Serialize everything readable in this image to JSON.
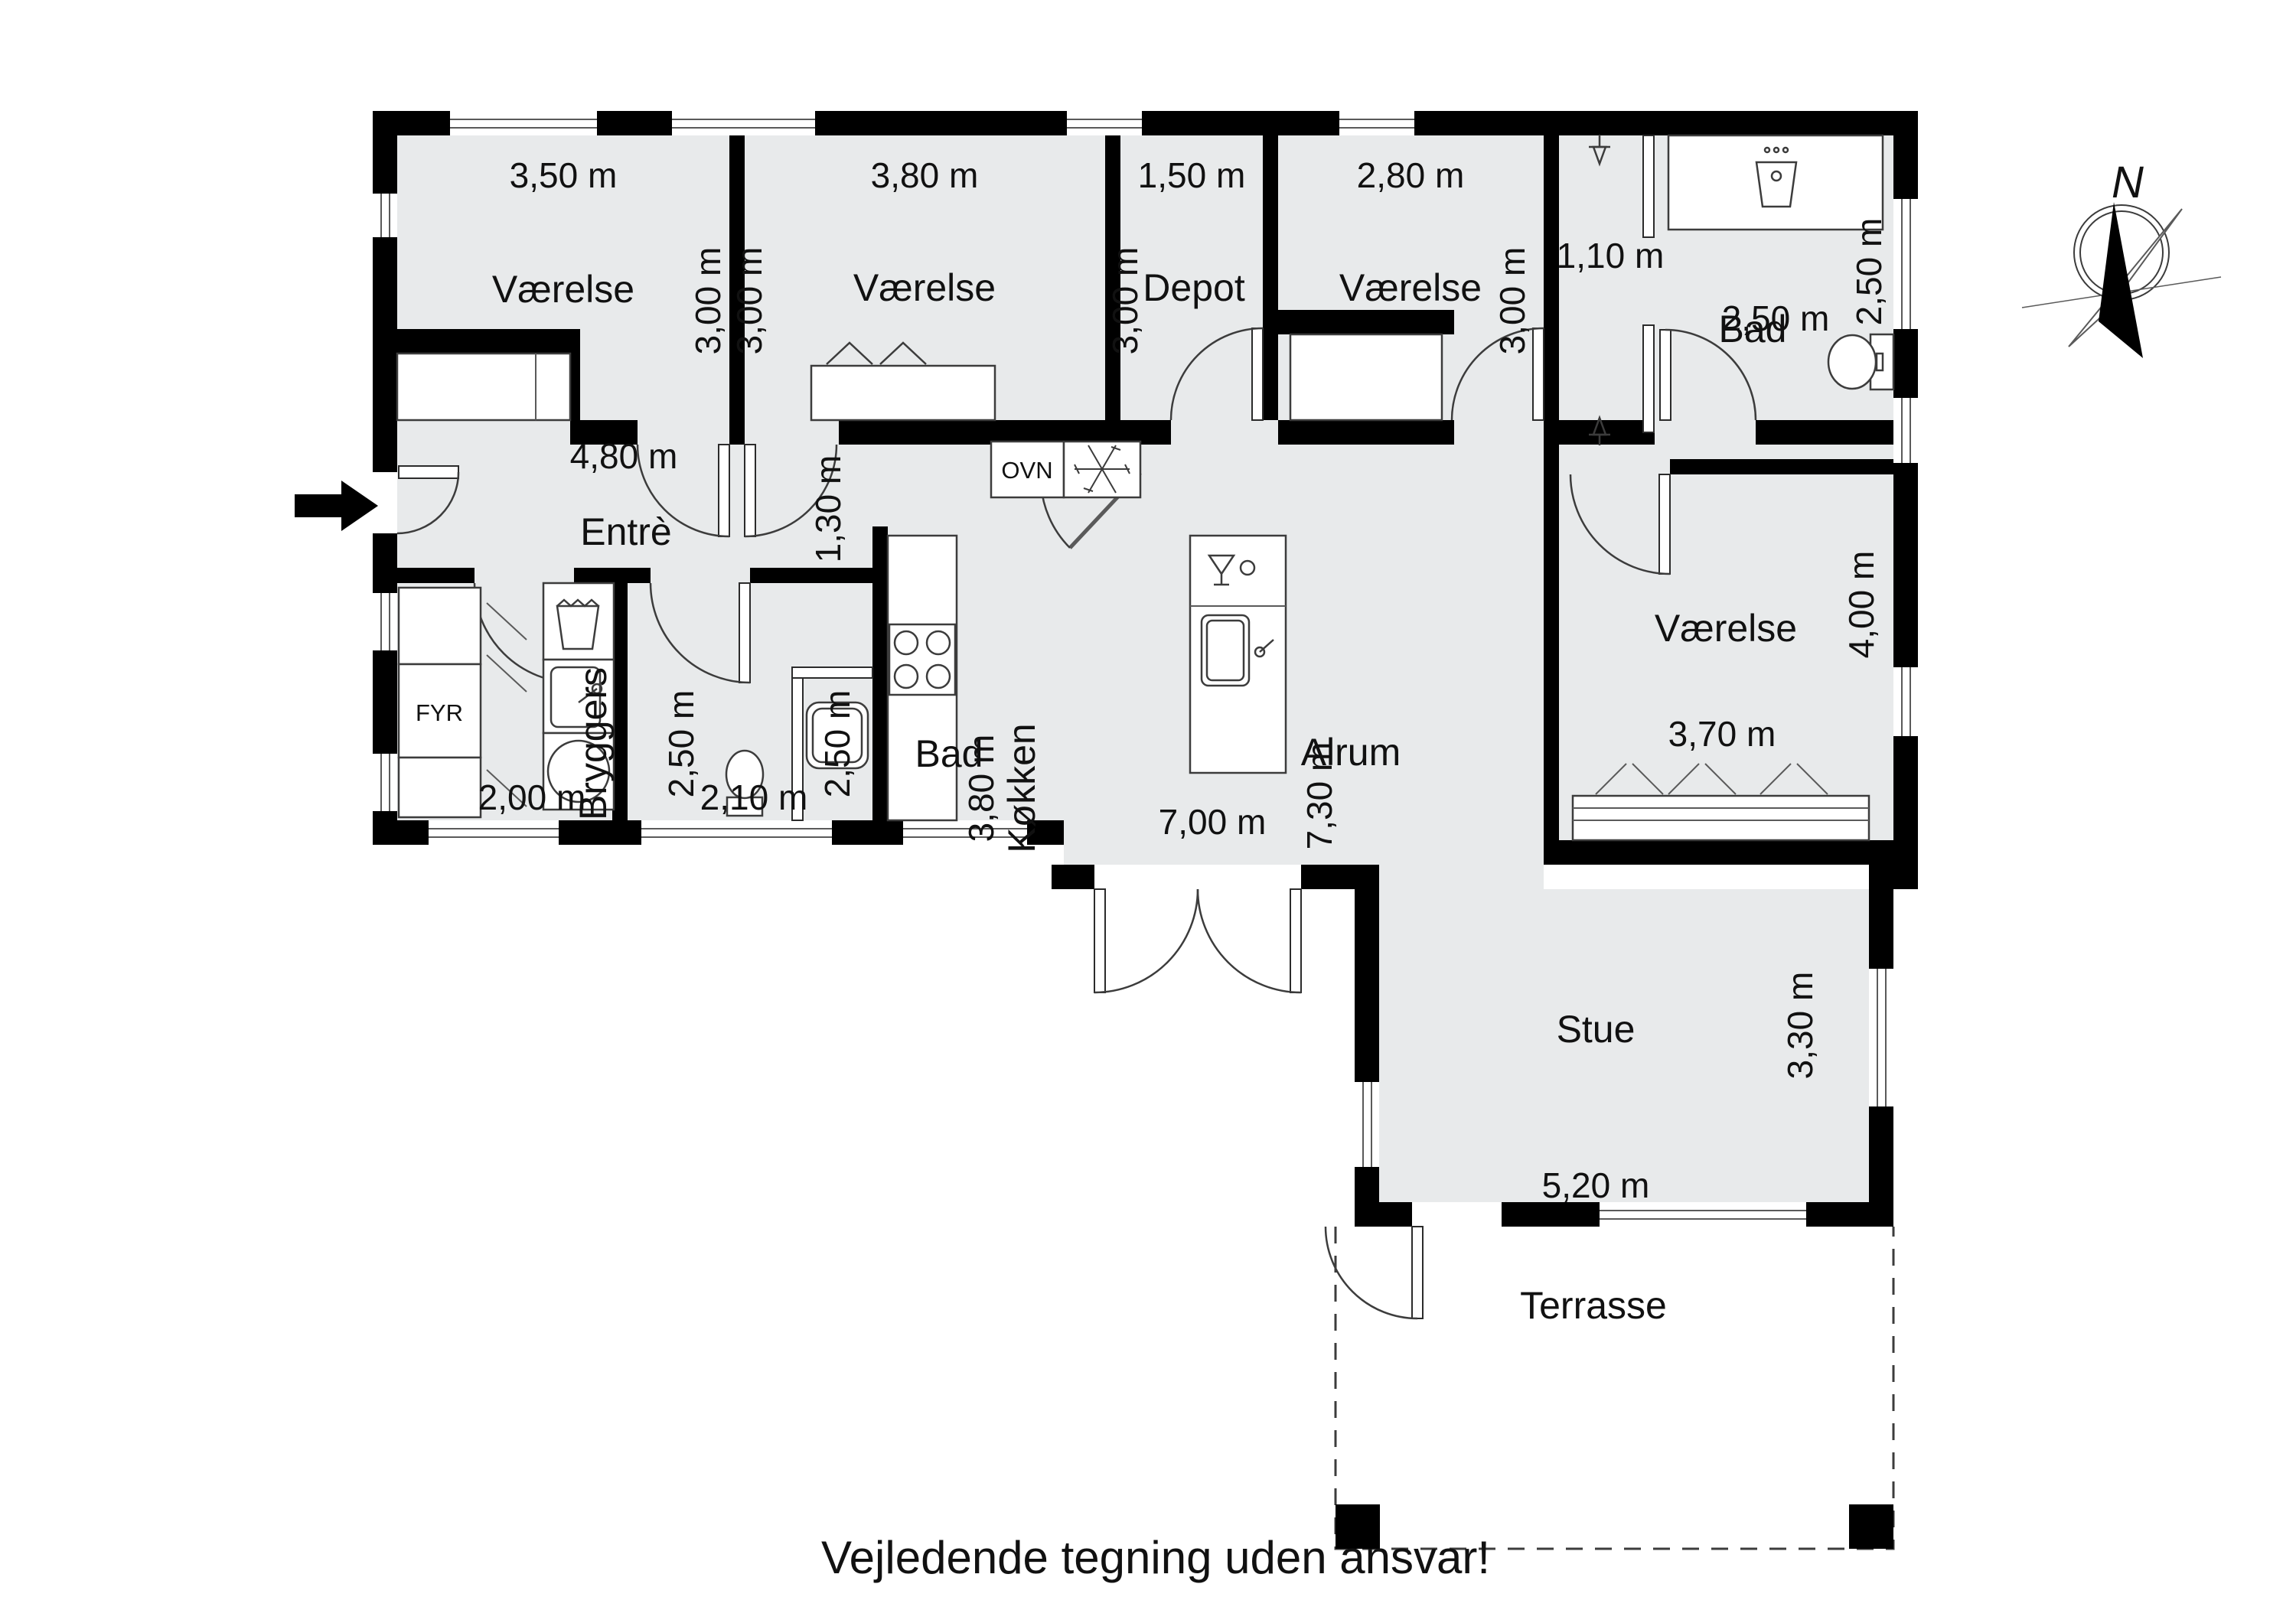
{
  "footer": {
    "disclaimer": "Vejledende tegning uden ansvar!"
  },
  "compass": {
    "north_label": "N"
  },
  "rooms": {
    "vaerelse1": "Værelse",
    "vaerelse2": "Værelse",
    "depot": "Depot",
    "vaerelse3": "Værelse",
    "bad_top": "Bad",
    "entre": "Entrè",
    "bryggers": "Bryggers",
    "bad_mid": "Bad",
    "koekken": "Køkken",
    "alrum": "Alrum",
    "vaerelse4": "Værelse",
    "stue": "Stue",
    "terrasse": "Terrasse"
  },
  "fixtures": {
    "oven": "OVN",
    "furnace": "FYR"
  },
  "dimensions": {
    "v1_w": "3,50 m",
    "v1_h": "3,00 m",
    "v2_w": "3,80 m",
    "v2_h": "3,00 m",
    "depot_w": "1,50 m",
    "depot_h": "3,00 m",
    "v3_w": "2,80 m",
    "v3_h": "3,00 m",
    "bad_top_niche": "1,10 m",
    "bad_top_w": "2,50 m",
    "bad_top_h": "2,50 m",
    "entre_w": "4,80 m",
    "hall_w": "1,30 m",
    "bryggers_w": "2,00 m",
    "bryggers_h": "2,50 m",
    "bad_mid_w": "2,10 m",
    "bad_mid_h": "2,50 m",
    "koekken_h": "3,80 m",
    "alrum_w": "7,00 m",
    "alrum_h": "7,30 m",
    "vaerelse4_w": "3,70 m",
    "vaerelse4_h": "4,00 m",
    "stue_w": "5,20 m",
    "stue_h": "3,30 m"
  }
}
